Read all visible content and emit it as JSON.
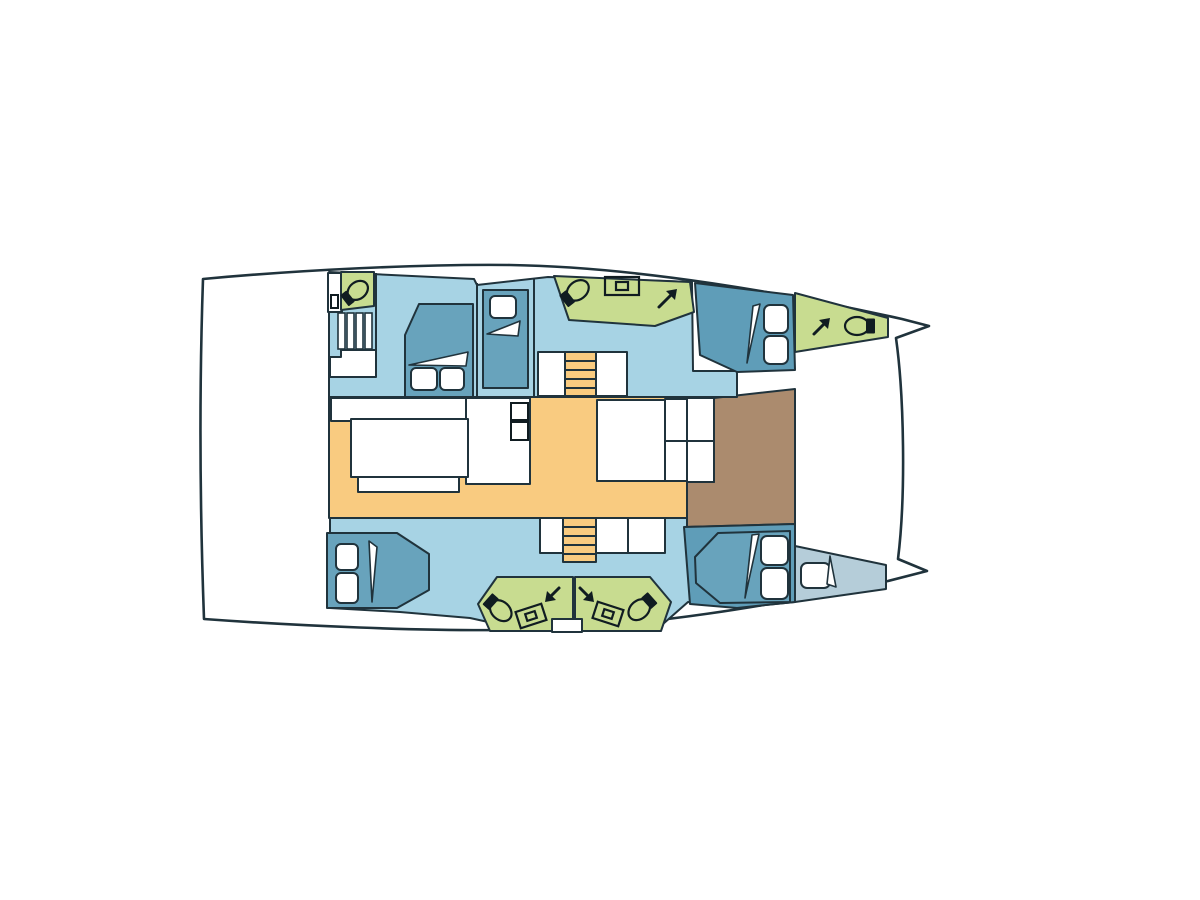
{
  "app": {
    "title": "Catamaran interior layout plan",
    "background": "#ffffff"
  },
  "diagram": {
    "type": "boat-floor-plan",
    "vessel": "catamaran",
    "view": "top-down deck plan",
    "orientation": "bow-right",
    "colors": {
      "background": "#ffffff",
      "outline": "#20333c",
      "floor_blue": "#a7d3e4",
      "bed_teal": "#68a3bc",
      "cabin_teal": "#5f9db8",
      "bow_gray_blue": "#b5cdd9",
      "head_green": "#c8dc90",
      "salon_orange": "#f9cb80",
      "cockpit_brown": "#ab8b6e",
      "furniture_white": "#ffffff",
      "fixture_black": "#101c21"
    },
    "rooms": [
      "aft cockpit",
      "port aft head",
      "port companionway steps",
      "port aft cabin",
      "port mid single berth",
      "port forward head",
      "port forward cabin",
      "port bow head",
      "salon galley",
      "salon table",
      "salon dinette",
      "forward cockpit",
      "starboard aft cabin",
      "starboard aft bathroom",
      "starboard forward bathroom",
      "starboard forward cabin",
      "starboard bow berth",
      "foredeck"
    ],
    "features": {
      "toilets": 5,
      "sinks": 3,
      "beds": 6,
      "staircases": 4,
      "hatch_arrows": 4
    },
    "icons": {
      "toilet-icon": "ellipse bowl with black tank block",
      "sink-icon": "rectangle with inner basin rectangle",
      "steps-icon": "striped tread rungs",
      "stair-icon": "orange treads with rails",
      "hatch-arrow-icon": "diagonal arrow"
    }
  }
}
